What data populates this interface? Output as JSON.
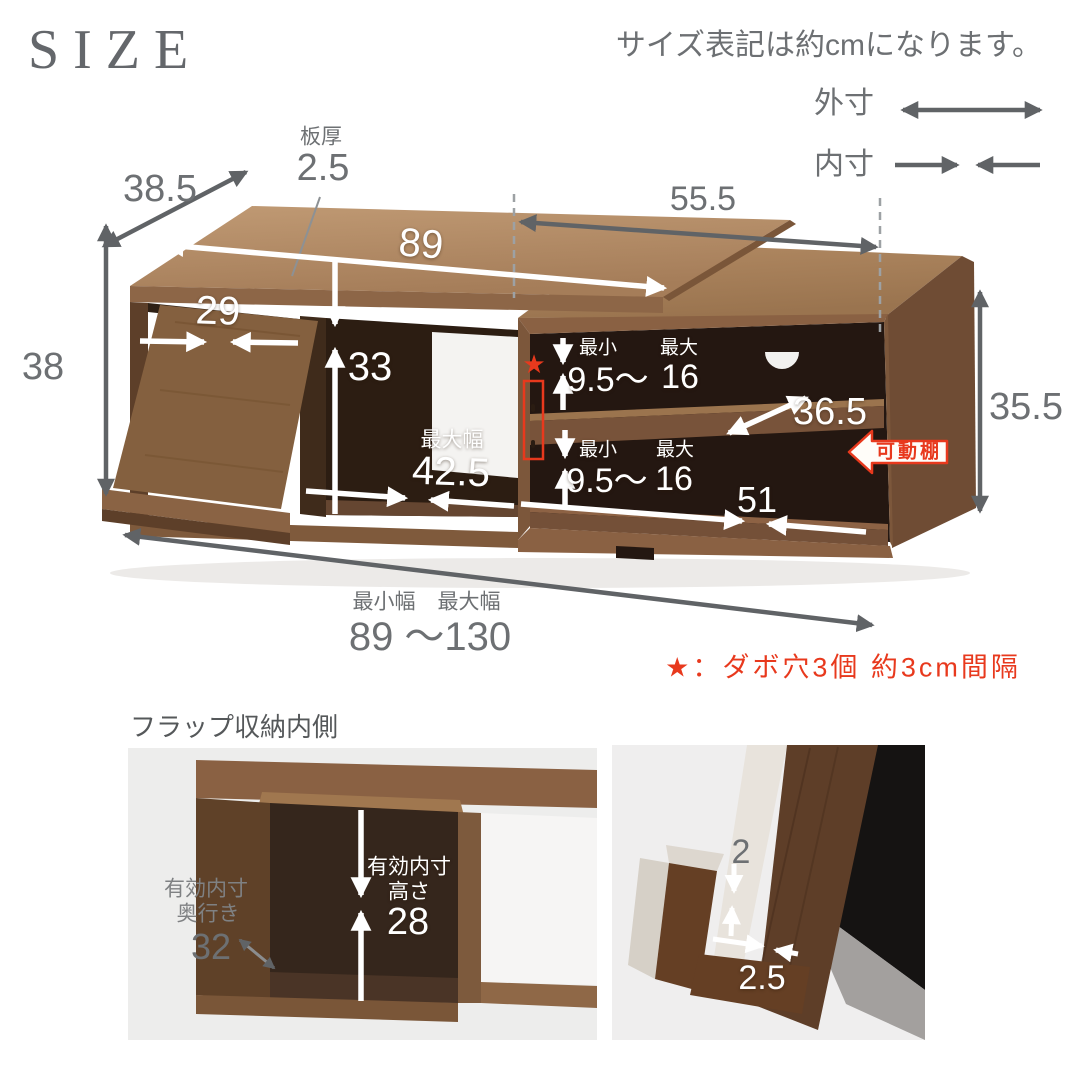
{
  "page": {
    "background": "#ffffff"
  },
  "header": {
    "title": "SIZE",
    "unit_note": "サイズ表記は約cmになります。"
  },
  "legend": {
    "outer_label": "外寸",
    "inner_label": "内寸"
  },
  "colors": {
    "accent_red": "#e8391d",
    "dim_text_gray": "#6d7073",
    "arrow_gray": "#606366",
    "white": "#ffffff",
    "wood_top": "#b18a64",
    "wood_front": "#8d6647",
    "wood_side_dark": "#6a4832",
    "interior_dark": "#241711"
  },
  "main_diagram": {
    "depth_top": "38.5",
    "thickness_label": "板厚",
    "thickness_value": "2.5",
    "top_width": "89",
    "slide_width": "55.5",
    "flap_inner_width": "29",
    "left_inner_height": "33",
    "left_outer_height": "38",
    "right_outer_height": "35.5",
    "center_max_label": "最大幅",
    "center_max_value": "42.5",
    "shelf_min_label": "最小",
    "shelf_max_label": "最大",
    "shelf_range_from": "9.5～",
    "shelf_range_to": "16",
    "inner_depth": "36.5",
    "bottom_inner_width": "51",
    "min_width_label": "最小幅",
    "max_width_label": "最大幅",
    "width_range": "89 ～130",
    "movable_shelf_badge": "可動棚",
    "star_icon": "★",
    "dowel_note": "★：ダボ穴3個 約3cm間隔"
  },
  "flap_section": {
    "title": "フラップ収納内側",
    "depth_label_line1": "有効内寸",
    "depth_label_line2": "奥行き",
    "depth_value": "32",
    "height_label_line1": "有効内寸",
    "height_label_line2": "高さ",
    "height_value": "28"
  },
  "flap_detail": {
    "lip_thickness": "2",
    "gap_width": "2.5"
  }
}
